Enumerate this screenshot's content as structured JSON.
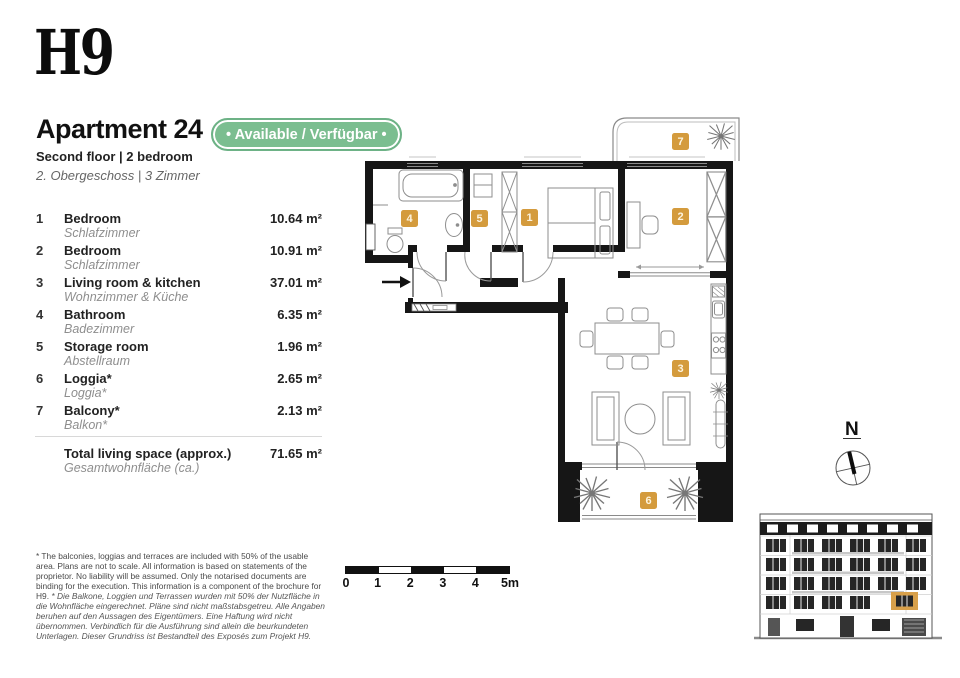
{
  "brand": {
    "logo": "H9"
  },
  "header": {
    "title": "Apartment 24",
    "availability": "• Available / Verfügbar •",
    "subtitle_en": "Second floor | 2 bedroom",
    "subtitle_de": "2. Obergeschoss | 3 Zimmer"
  },
  "rooms": [
    {
      "num": "1",
      "name_en": "Bedroom",
      "name_de": "Schlafzimmer",
      "area": "10.64 m²"
    },
    {
      "num": "2",
      "name_en": "Bedroom",
      "name_de": "Schlafzimmer",
      "area": "10.91 m²"
    },
    {
      "num": "3",
      "name_en": "Living room & kitchen",
      "name_de": "Wohnzimmer & Küche",
      "area": "37.01 m²"
    },
    {
      "num": "4",
      "name_en": "Bathroom",
      "name_de": "Badezimmer",
      "area": "6.35 m²"
    },
    {
      "num": "5",
      "name_en": "Storage room",
      "name_de": "Abstellraum",
      "area": "1.96 m²"
    },
    {
      "num": "6",
      "name_en": "Loggia*",
      "name_de": "Loggia*",
      "area": "2.65 m²"
    },
    {
      "num": "7",
      "name_en": "Balcony*",
      "name_de": "Balkon*",
      "area": "2.13 m²"
    }
  ],
  "total": {
    "label_en": "Total living space (approx.)",
    "label_de": "Gesamtwohnfläche (ca.)",
    "value": "71.65 m²"
  },
  "disclaimer": {
    "en": "* The balconies, loggias and terraces are included with 50% of the usable area. Plans are not to scale. All information is based on statements of the proprietor. No liability will be assumed. Only the notarised documents are binding for the execution. This information is a component of the brochure for H9. ",
    "de": "* Die Balkone, Loggien und Terrassen wurden mit 50% der Nutzfläche in die Wohnfläche eingerechnet. Pläne sind nicht maßstabsgetreu. Alle Angaben beruhen auf den Aussagen des Eigentümers. Eine Haftung wird nicht übernommen. Verbindlich für die Ausführung sind allein die beurkundeten Unterlagen. Dieser Grundriss ist Bestandteil des Exposés zum Projekt H9."
  },
  "scale_bar": {
    "ticks": [
      "0",
      "1",
      "2",
      "3",
      "4",
      "5m"
    ]
  },
  "compass": {
    "label": "N"
  },
  "colors": {
    "accent_gold": "#D49B3D",
    "badge_green": "#7BBE90",
    "wall_black": "#161616"
  }
}
